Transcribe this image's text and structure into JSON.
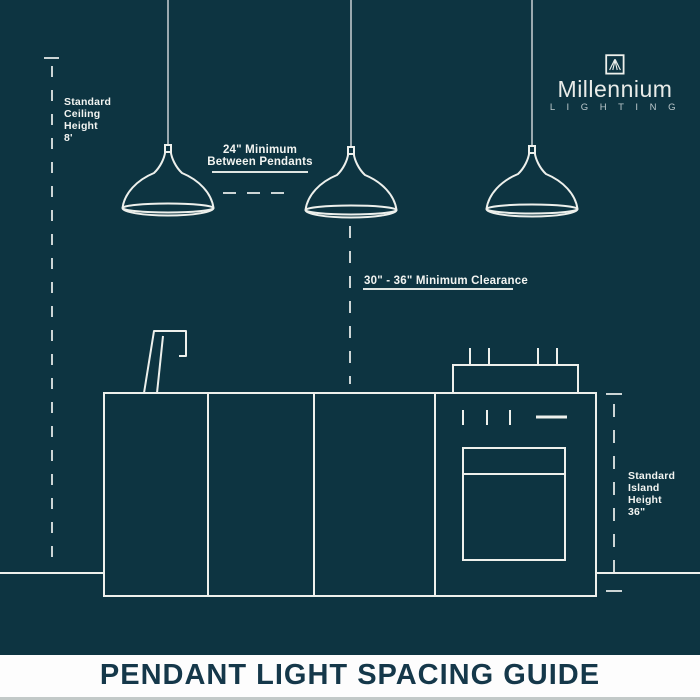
{
  "page": {
    "background_color": "#0d3441",
    "line_color": "#edf0ec",
    "dash_color": "#ccd5d5",
    "cord_color": "#9aa9af"
  },
  "brand": {
    "name": "Millennium",
    "tagline": "L I G H T I N G",
    "icon": "mountain-square-logo-icon"
  },
  "diagram": {
    "pendant_count": 3,
    "elements": [
      "pendant-light-icon",
      "kitchen-island-icon",
      "stove-oven-icon",
      "faucet-icon"
    ],
    "measurements": [
      {
        "id": "ceiling",
        "text": "Standard\nCeiling\nHeight\n8'"
      },
      {
        "id": "between",
        "text": "24\" Minimum\nBetween Pendants"
      },
      {
        "id": "clearance",
        "text": "30\" - 36\" Minimum Clearance"
      },
      {
        "id": "island",
        "text": "Standard\nIsland\nHeight\n36\""
      }
    ]
  },
  "labels": {
    "ceiling": "Standard\nCeiling\nHeight\n8'",
    "between_pendants": "24\" Minimum\nBetween Pendants",
    "clearance": "30\" - 36\" Minimum Clearance",
    "island": "Standard\nIsland\nHeight\n36\""
  },
  "footer": {
    "title": "PENDANT LIGHT SPACING GUIDE"
  }
}
